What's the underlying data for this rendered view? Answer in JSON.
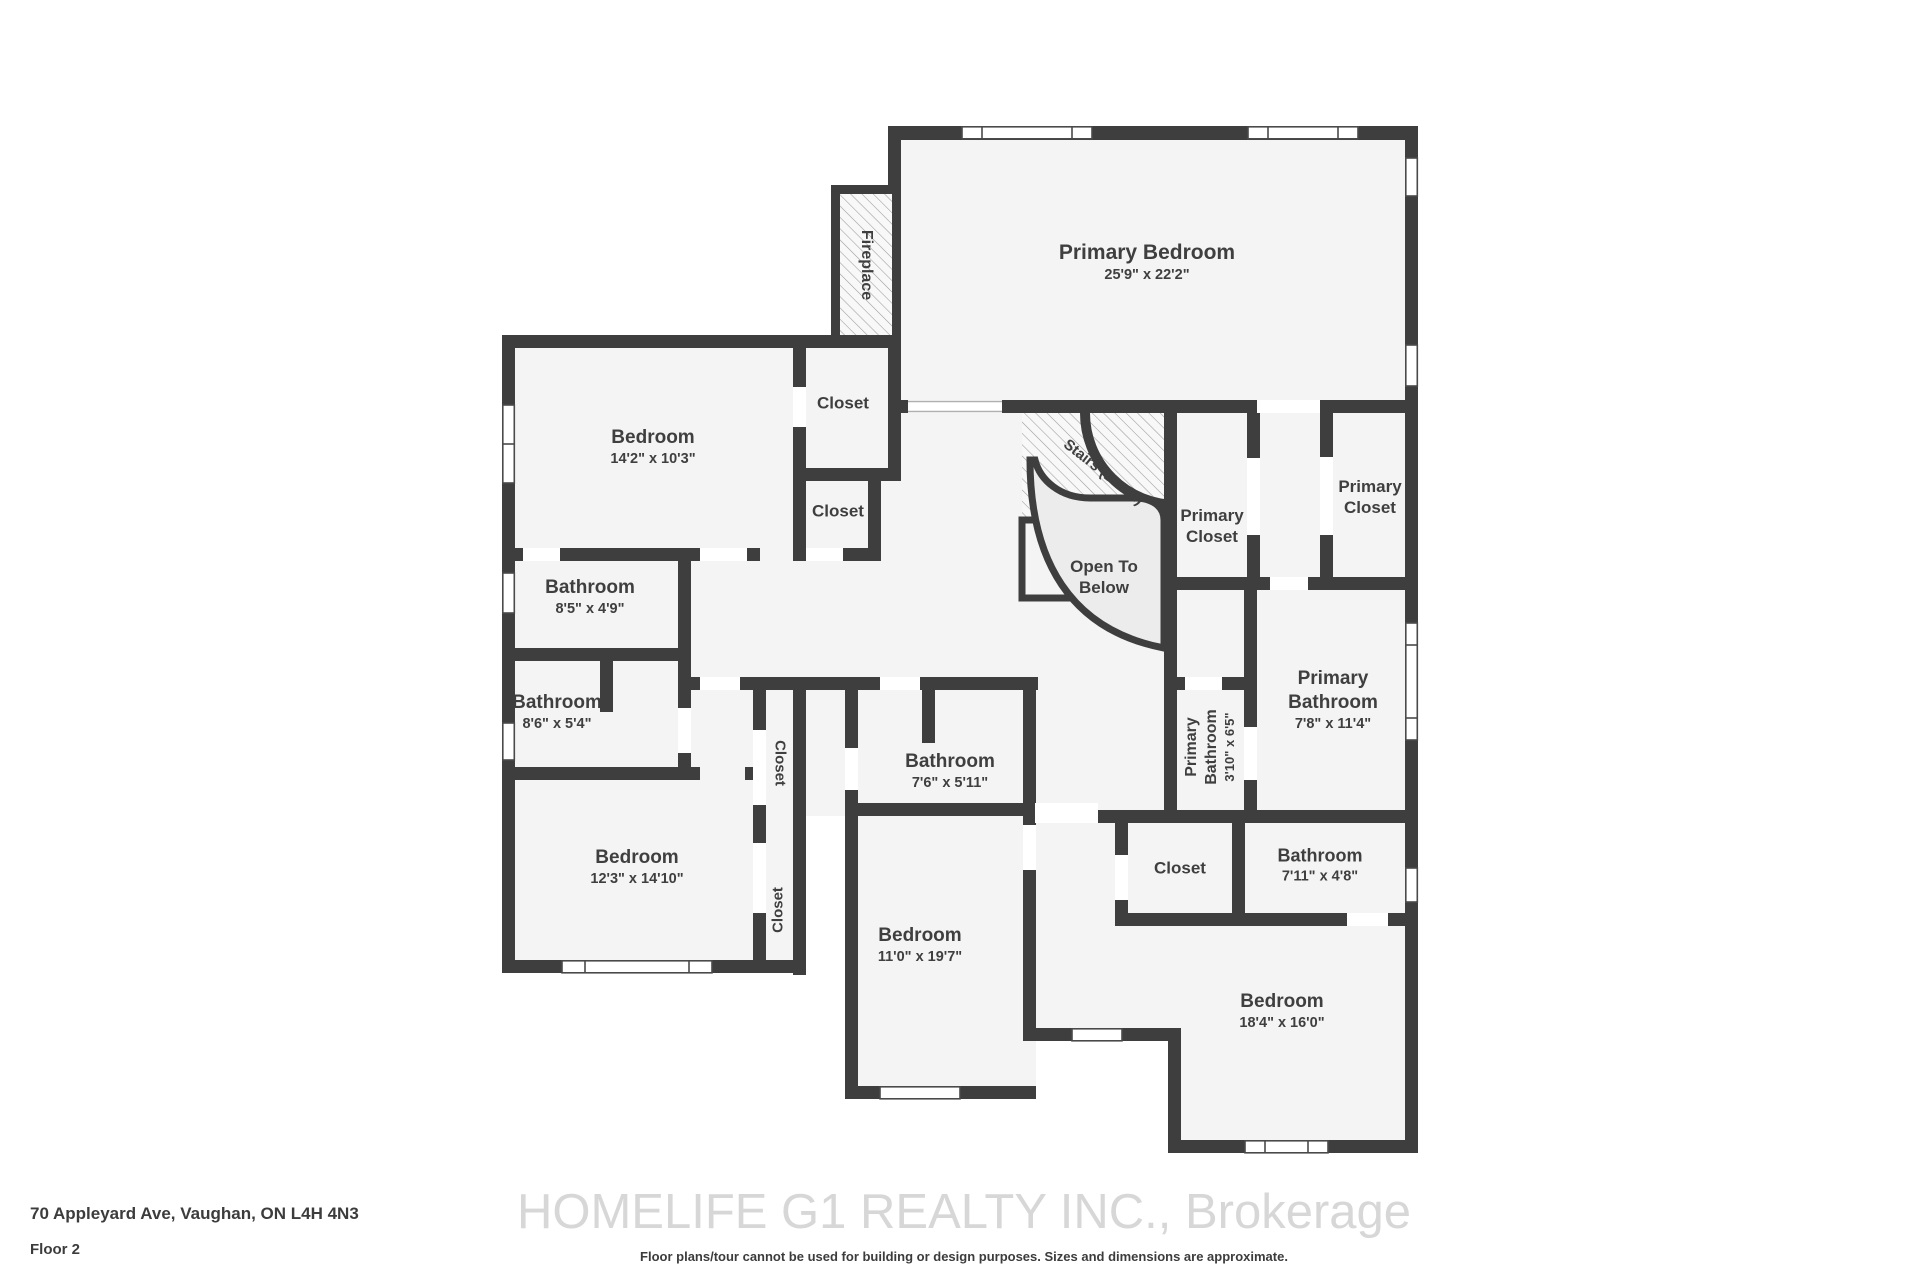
{
  "meta": {
    "sheet_title": "Floor plan - Floor 2"
  },
  "colors": {
    "wall": "#3e3e3e",
    "floor": "#f4f4f4",
    "open_below_fill": "#ececec",
    "hatch_line": "#9a9a9a",
    "label_text": "#3f3f3f",
    "watermark_text": "#d7d7d7"
  },
  "rooms": [
    {
      "name": "Primary Bedroom",
      "dims": "25'9\" x 22'2\""
    },
    {
      "name": "Bedroom",
      "dims": "14'2\" x 10'3\""
    },
    {
      "name": "Closet"
    },
    {
      "name": "Closet"
    },
    {
      "name": "Fireplace"
    },
    {
      "name": "Stairs (Down)"
    },
    {
      "name": "Open To Below"
    },
    {
      "name": "Primary Closet"
    },
    {
      "name": "Primary Closet"
    },
    {
      "name": "Primary Bathroom",
      "dims": "7'8\" x 11'4\""
    },
    {
      "name": "Primary Bathroom",
      "dims": "3'10\" x 6'5\""
    },
    {
      "name": "Bathroom",
      "dims": "7'6\" x 5'11\""
    },
    {
      "name": "Bathroom",
      "dims": "8'5\" x 4'9\""
    },
    {
      "name": "Bathroom",
      "dims": "8'6\" x 5'4\""
    },
    {
      "name": "Bedroom",
      "dims": "12'3\" x 14'10\""
    },
    {
      "name": "Bedroom",
      "dims": "11'0\" x 19'7\""
    },
    {
      "name": "Closet"
    },
    {
      "name": "Closet"
    },
    {
      "name": "Closet"
    },
    {
      "name": "Bathroom",
      "dims": "7'11\" x 4'8\""
    },
    {
      "name": "Bedroom",
      "dims": "18'4\" x 16'0\""
    }
  ],
  "footer": {
    "address": "70 Appleyard Ave, Vaughan, ON L4H 4N3",
    "floor": "Floor 2",
    "disclaimer": "Floor plans/tour cannot be used for building or design purposes. Sizes and dimensions are approximate."
  },
  "watermark": "HOMELIFE G1 REALTY INC., Brokerage"
}
